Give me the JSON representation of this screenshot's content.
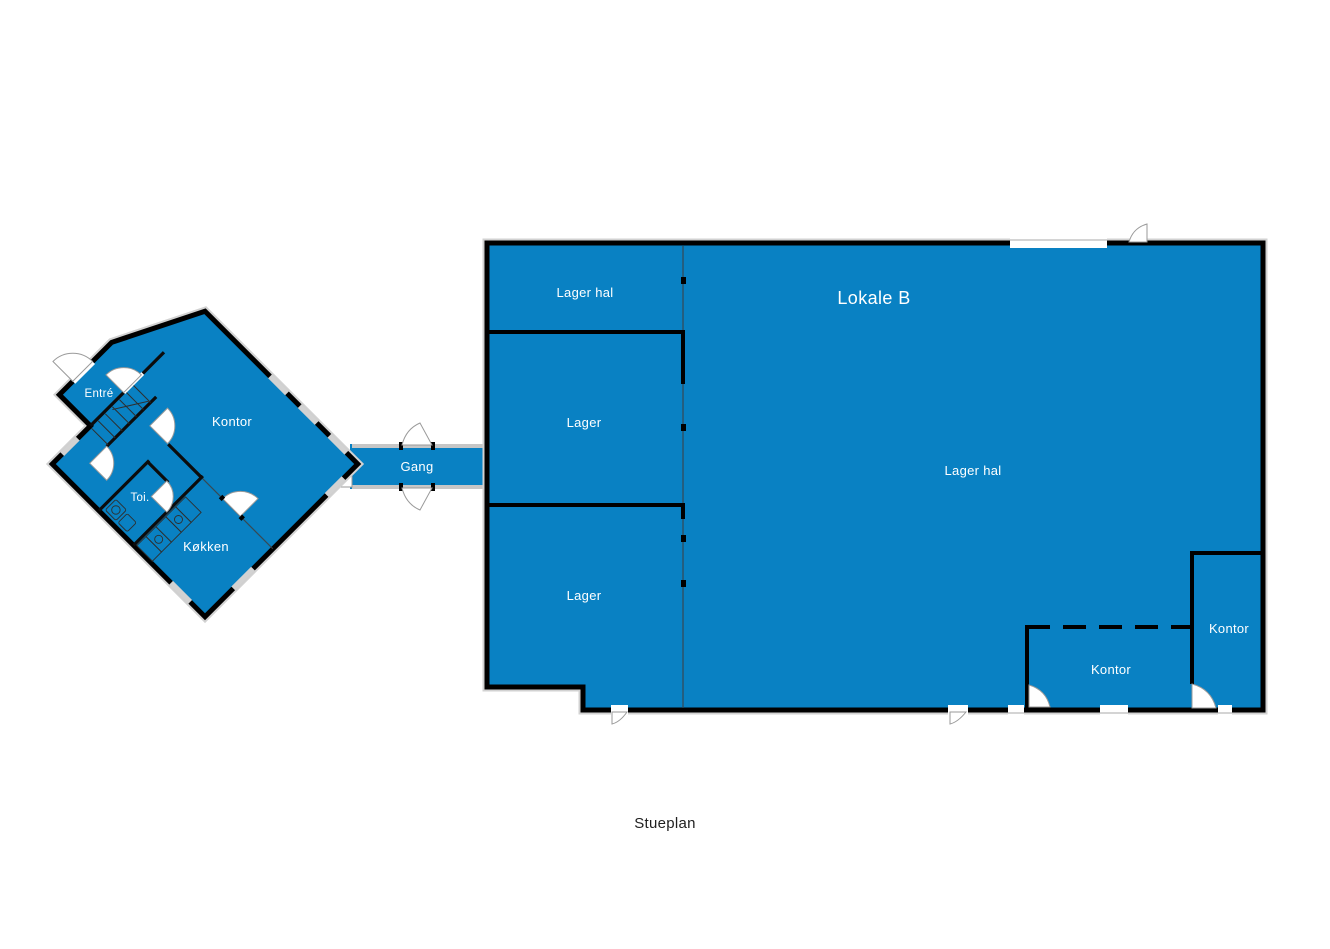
{
  "plan": {
    "caption": "Stueplan",
    "colors": {
      "background": "#ffffff",
      "room_fill": "#0981c3",
      "wall": "#000000",
      "corridor_wall": "#c6c6c6",
      "window_gap": "#d2d2d2",
      "room_label_text": "#ffffff",
      "caption_text": "#1f1f1f"
    },
    "left_building": {
      "rooms": {
        "entre": "Entré",
        "kontor": "Kontor",
        "toi": "Toi.",
        "kokken": "Køkken"
      }
    },
    "corridor": {
      "gang": "Gang"
    },
    "right_building": {
      "title": "Lokale B",
      "rooms": {
        "lager_hal_top": "Lager hal",
        "lager_mid": "Lager",
        "lager_bottom": "Lager",
        "lager_hal_main": "Lager hal",
        "kontor_mid": "Kontor",
        "kontor_right": "Kontor"
      }
    }
  }
}
